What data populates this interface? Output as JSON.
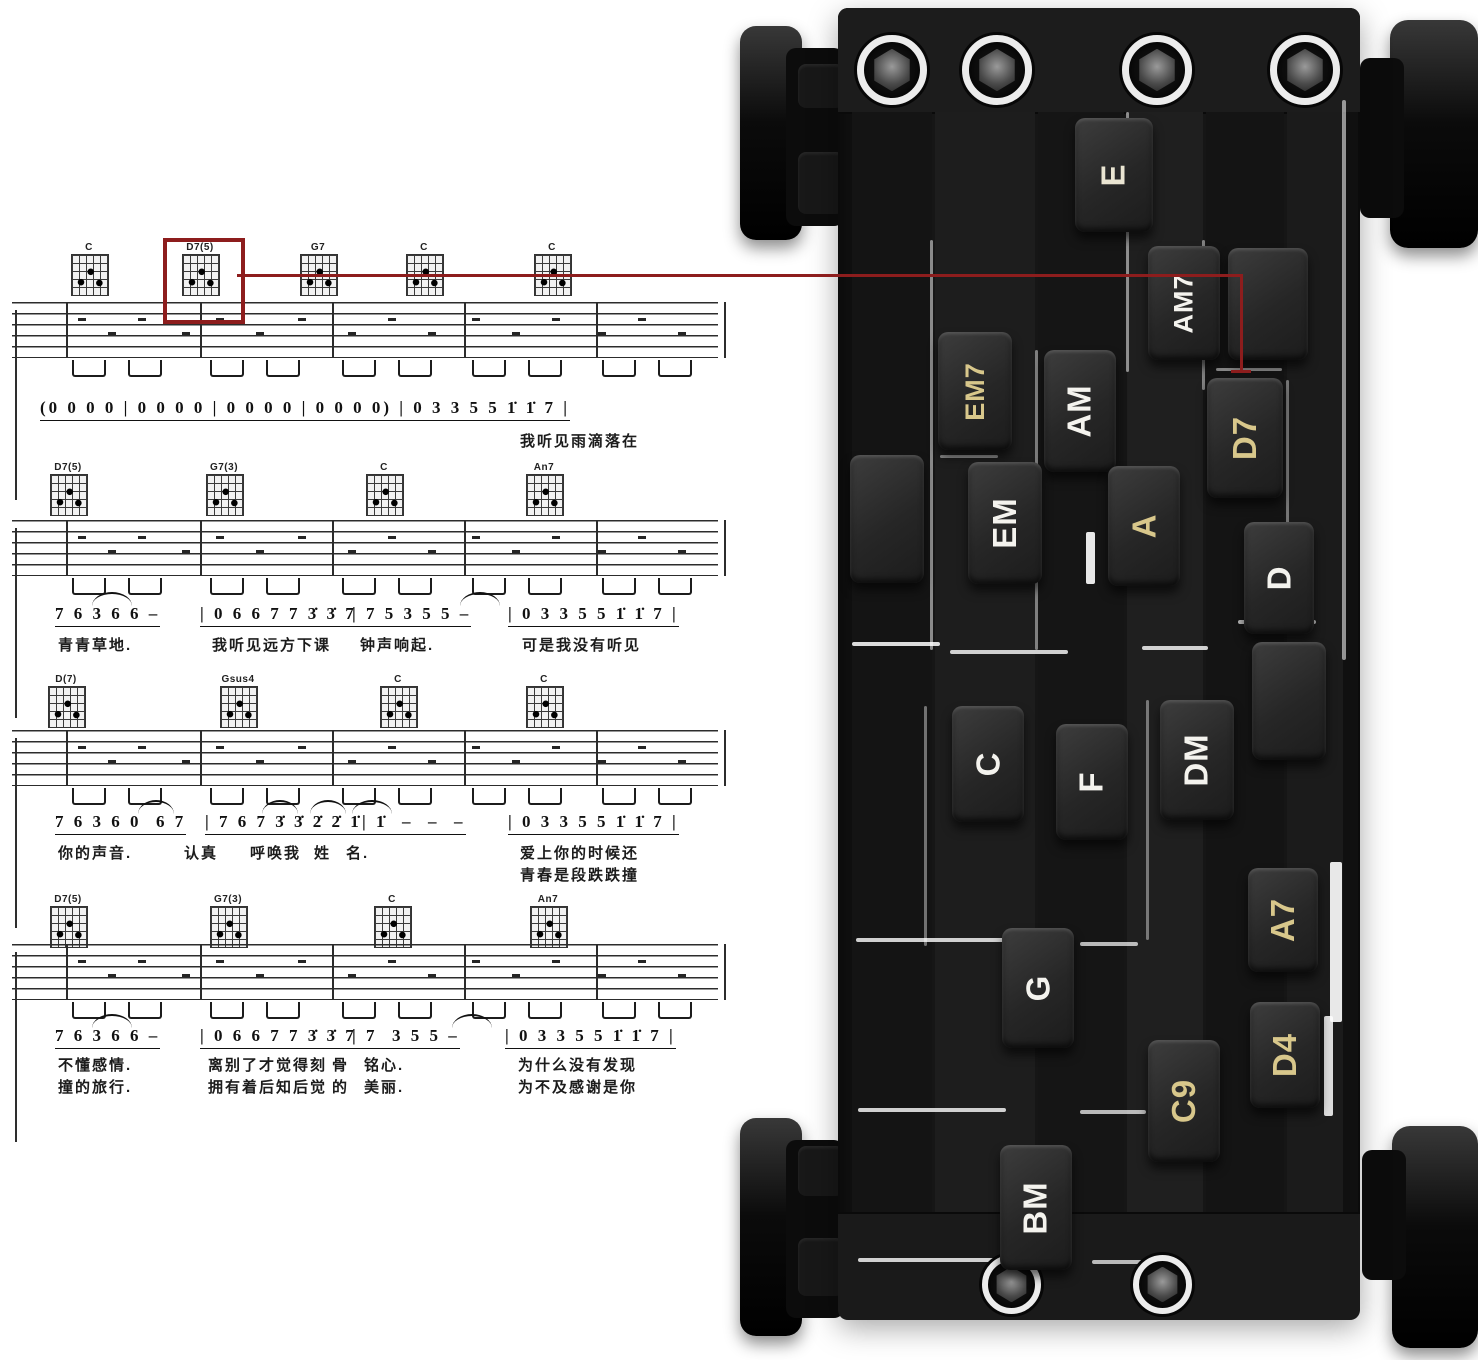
{
  "sheet": {
    "systems": [
      {
        "chord_y": 242,
        "staff_y": 302,
        "num_y": 398,
        "lyric_y": [
          430
        ],
        "chords": [
          {
            "name": "C",
            "x": 89
          },
          {
            "name": "D7(5)",
            "x": 200
          },
          {
            "name": "G7",
            "x": 318
          },
          {
            "name": "C",
            "x": 424
          },
          {
            "name": "C",
            "x": 552
          }
        ],
        "numbers": [
          {
            "t": "(0 0 0 0 | 0 0 0 0 | 0 0 0 0 | 0 0 0 0) | 0 3 3 5 5 1̇ 1̇ 7 |",
            "x": 40
          }
        ],
        "arcs": [],
        "lyrics": [
          {
            "t": "我听见雨滴落在",
            "x": 520,
            "row": 0
          }
        ]
      },
      {
        "chord_y": 462,
        "staff_y": 520,
        "num_y": 604,
        "lyric_y": [
          634
        ],
        "chords": [
          {
            "name": "D7(5)",
            "x": 68
          },
          {
            "name": "G7(3)",
            "x": 224
          },
          {
            "name": "C",
            "x": 384
          },
          {
            "name": "An7",
            "x": 544
          }
        ],
        "numbers": [
          {
            "t": "7 6 3 6 6 –",
            "x": 55
          },
          {
            "t": "| 0 6 6 7 7 3̇ 3̇ 7",
            "x": 200
          },
          {
            "t": "| 7 5 3 5 5 –",
            "x": 352
          },
          {
            "t": "| 0 3 3 5 5 1̇ 1̇ 7 |",
            "x": 508
          }
        ],
        "arcs": [
          {
            "x": 92,
            "w": 40
          },
          {
            "x": 460,
            "w": 40
          }
        ],
        "lyrics": [
          {
            "t": "青青草地.",
            "x": 58,
            "row": 0
          },
          {
            "t": "我听见远方下课",
            "x": 212,
            "row": 0
          },
          {
            "t": "钟声响起.",
            "x": 360,
            "row": 0
          },
          {
            "t": "可是我没有听见",
            "x": 522,
            "row": 0
          }
        ]
      },
      {
        "chord_y": 674,
        "staff_y": 730,
        "num_y": 812,
        "lyric_y": [
          842,
          864
        ],
        "chords": [
          {
            "name": "D(7)",
            "x": 66
          },
          {
            "name": "Gsus4",
            "x": 238
          },
          {
            "name": "C",
            "x": 398
          },
          {
            "name": "C",
            "x": 544
          }
        ],
        "numbers": [
          {
            "t": "7 6 3 6 0  6 7",
            "x": 55
          },
          {
            "t": "| 7 6 7 3̇ 3̇ 2̇ 2̇ 1̇",
            "x": 205
          },
          {
            "t": "| 1̇  –  –  –",
            "x": 362
          },
          {
            "t": "| 0 3 3 5 5 1̇ 1̇ 7 |",
            "x": 508
          }
        ],
        "arcs": [
          {
            "x": 138,
            "w": 36
          },
          {
            "x": 262,
            "w": 36
          },
          {
            "x": 310,
            "w": 36
          },
          {
            "x": 352,
            "w": 40
          }
        ],
        "lyrics": [
          {
            "t": "你的声音.",
            "x": 58,
            "row": 0
          },
          {
            "t": "认真",
            "x": 184,
            "row": 0
          },
          {
            "t": "呼唤我",
            "x": 250,
            "row": 0
          },
          {
            "t": "姓",
            "x": 314,
            "row": 0
          },
          {
            "t": "名.",
            "x": 346,
            "row": 0
          },
          {
            "t": "爱上你的时候还",
            "x": 520,
            "row": 0
          },
          {
            "t": "青春是段跌跌撞",
            "x": 520,
            "row": 1
          }
        ]
      },
      {
        "chord_y": 894,
        "staff_y": 944,
        "num_y": 1026,
        "lyric_y": [
          1054,
          1076
        ],
        "chords": [
          {
            "name": "D7(5)",
            "x": 68
          },
          {
            "name": "G7(3)",
            "x": 228
          },
          {
            "name": "C",
            "x": 392
          },
          {
            "name": "An7",
            "x": 548
          }
        ],
        "numbers": [
          {
            "t": "7 6 3 6 6 –",
            "x": 55
          },
          {
            "t": "| 0 6 6 7 7 3̇ 3̇ 7",
            "x": 200
          },
          {
            "t": "| 7  3 5 5 –",
            "x": 352
          },
          {
            "t": "| 0 3 3 5 5 1̇ 1̇ 7 |",
            "x": 505
          }
        ],
        "arcs": [
          {
            "x": 92,
            "w": 40
          },
          {
            "x": 452,
            "w": 40
          }
        ],
        "lyrics": [
          {
            "t": "不懂感情.",
            "x": 58,
            "row": 0
          },
          {
            "t": "离别了才觉得刻",
            "x": 208,
            "row": 0
          },
          {
            "t": "骨",
            "x": 332,
            "row": 0
          },
          {
            "t": "铭心.",
            "x": 364,
            "row": 0
          },
          {
            "t": "为什么没有发现",
            "x": 518,
            "row": 0
          },
          {
            "t": "撞的旅行.",
            "x": 58,
            "row": 1
          },
          {
            "t": "拥有着后知后觉",
            "x": 208,
            "row": 1
          },
          {
            "t": "的",
            "x": 332,
            "row": 1
          },
          {
            "t": "美丽.",
            "x": 364,
            "row": 1
          },
          {
            "t": "为不及感谢是你",
            "x": 518,
            "row": 1
          }
        ]
      }
    ],
    "connector": {
      "color": "#8d1d1d",
      "box": {
        "x": 163,
        "y": 238,
        "w": 74,
        "h": 78
      },
      "h_line": {
        "x1": 237,
        "x2": 1243,
        "y": 274
      },
      "v_line": {
        "x": 1240,
        "y1": 274,
        "y2": 372
      },
      "tick": {
        "x": 1231,
        "y": 370,
        "w": 20
      }
    },
    "highlighted_chord": "D7(5)",
    "target_key": "D7"
  },
  "device": {
    "colors": {
      "white": "#f4f3ee",
      "gold": "#d8c78b",
      "cream": "#eae5d2"
    },
    "keys": [
      {
        "label": "E",
        "x": 1075,
        "y": 118,
        "w": 78,
        "h": 114,
        "c": "cream"
      },
      {
        "label": "AM7",
        "x": 1148,
        "y": 246,
        "w": 72,
        "h": 114,
        "c": "white"
      },
      {
        "label": "",
        "x": 1228,
        "y": 248,
        "w": 80,
        "h": 112,
        "c": "white"
      },
      {
        "label": "EM7",
        "x": 938,
        "y": 332,
        "w": 74,
        "h": 118,
        "c": "gold"
      },
      {
        "label": "AM",
        "x": 1044,
        "y": 350,
        "w": 72,
        "h": 122,
        "c": "white"
      },
      {
        "label": "D7",
        "x": 1207,
        "y": 378,
        "w": 76,
        "h": 120,
        "c": "gold"
      },
      {
        "label": "EM",
        "x": 968,
        "y": 462,
        "w": 74,
        "h": 122,
        "c": "white"
      },
      {
        "label": "A",
        "x": 1108,
        "y": 466,
        "w": 72,
        "h": 120,
        "c": "gold"
      },
      {
        "label": "D",
        "x": 1244,
        "y": 522,
        "w": 70,
        "h": 112,
        "c": "white"
      },
      {
        "label": "",
        "x": 850,
        "y": 455,
        "w": 74,
        "h": 128,
        "c": "white"
      },
      {
        "label": "C",
        "x": 952,
        "y": 706,
        "w": 72,
        "h": 116,
        "c": "white"
      },
      {
        "label": "F",
        "x": 1056,
        "y": 724,
        "w": 72,
        "h": 116,
        "c": "white"
      },
      {
        "label": "DM",
        "x": 1160,
        "y": 700,
        "w": 74,
        "h": 120,
        "c": "white"
      },
      {
        "label": "",
        "x": 1252,
        "y": 642,
        "w": 74,
        "h": 118,
        "c": "white"
      },
      {
        "label": "G",
        "x": 1002,
        "y": 928,
        "w": 72,
        "h": 120,
        "c": "white"
      },
      {
        "label": "A7",
        "x": 1248,
        "y": 868,
        "w": 70,
        "h": 104,
        "c": "gold"
      },
      {
        "label": "C9",
        "x": 1148,
        "y": 1040,
        "w": 72,
        "h": 122,
        "c": "gold"
      },
      {
        "label": "D4",
        "x": 1250,
        "y": 1002,
        "w": 70,
        "h": 106,
        "c": "gold"
      },
      {
        "label": "BM",
        "x": 1000,
        "y": 1145,
        "w": 72,
        "h": 125,
        "c": "white"
      }
    ],
    "screws_top": [
      {
        "x": 892,
        "y": 70
      },
      {
        "x": 997,
        "y": 70
      },
      {
        "x": 1157,
        "y": 70
      },
      {
        "x": 1305,
        "y": 70
      }
    ],
    "screws_bottom": [
      {
        "x": 1012,
        "y": 1285
      },
      {
        "x": 1163,
        "y": 1285
      }
    ]
  }
}
